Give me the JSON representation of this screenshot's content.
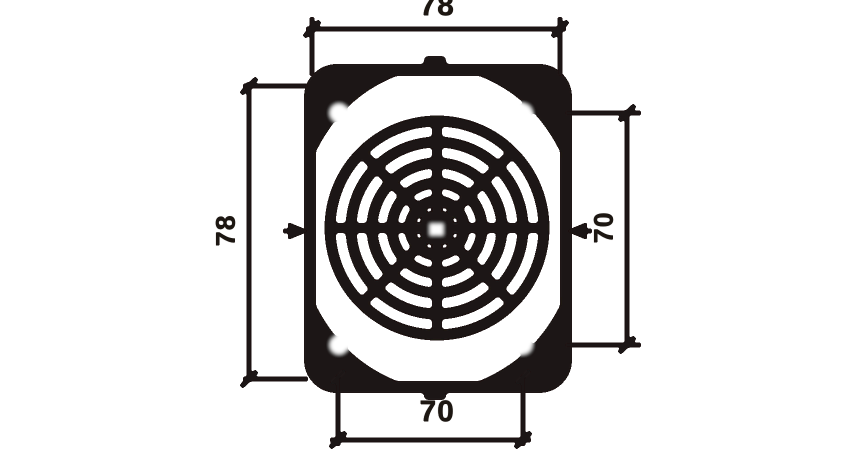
{
  "colors": {
    "ink": "#1d1712",
    "paper": "#ffffff"
  },
  "dimensions": {
    "top_overall_width": "78",
    "bottom_hole_spacing": "70",
    "left_overall_height": "78",
    "right_hole_spacing": "70"
  }
}
